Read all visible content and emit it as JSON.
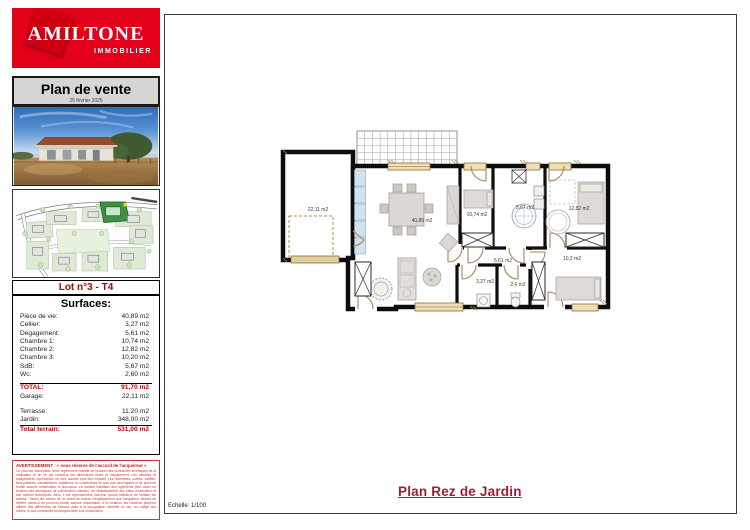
{
  "colors": {
    "brand_red": "#e2001a",
    "accent_red": "#cc0000",
    "plan_title_red": "#9e1f35"
  },
  "sidebar": {
    "logo": {
      "brand": "AMILTONE",
      "tagline": "IMMOBILIER"
    },
    "header": {
      "title": "Plan de vente",
      "date": "25 février 2025"
    },
    "lot_label": "Lot n°3 - T4",
    "surfaces": {
      "title": "Surfaces:",
      "rows": [
        {
          "label": "Pièce de vie:",
          "value": "40,89 m2"
        },
        {
          "label": "Cellier:",
          "value": "3,27 m2"
        },
        {
          "label": "Degagement:",
          "value": "5,61 m2"
        },
        {
          "label": "Chambre 1:",
          "value": "10,74 m2"
        },
        {
          "label": "Chambre 2:",
          "value": "12,82 m2"
        },
        {
          "label": "Chambre 3:",
          "value": "10,20 m2"
        },
        {
          "label": "SdB:",
          "value": "5,67 m2"
        },
        {
          "label": "Wc:",
          "value": "2,60 m2"
        }
      ],
      "summary": [
        {
          "label": "TOTAL:",
          "value": "91,70 m2"
        },
        {
          "label": "Garage:",
          "value": "22,11 m2"
        },
        {
          "label": "Terrasse:",
          "value": "11,20 m2"
        },
        {
          "label": "Jardin:",
          "value": "348,00 m2"
        },
        {
          "label": "Total terrain:",
          "value": "531,00 m2"
        }
      ]
    },
    "warning": {
      "title": "AVERTISSEMENT : « sous réserve de l'accord de l'acquéreur »",
      "body": "Ce plan est susceptible d'être légèrement modifié en fonction des contraintes techniques de la réalisation et en ce qui concerne les dimensions libres et l'équipement. Les meubles et équipements représentés ne sont donnés qu'à titre indicatif. Les retombées, coffres, soffites, faux-plafonds, canalisations, radiateurs ou convecteurs ne sont pas tous figurés et ne pourront fonder aucune réclamation ni plus-value. La surface habitable des logements peut varier en fonction des techniques de construction choisies, de l'établissement des plans d'exécution et des normes techniques. Ainsi, il est expressément convenu qu'une tolérance de surface est admise. Toutes les ventes de m² étant au niveau d'emplacement que l'acquéreur tiendra de vérifier, celles-ci ne pourront fonder aucune réclamation. A la livraison, les hauteurs pourront différer des différences de niveaux dues à la topographie naturelle du lieu, au calage des voiries, et aux contraintes techniques liées à la construction."
    }
  },
  "main": {
    "plan_title": "Plan Rez de Jardin",
    "scale": "Echelle: 1/100",
    "rooms": {
      "garage": "22,11 m2",
      "living": "40,89 m2",
      "bedroom1": "10,74 m2",
      "bathroom": "5,67 m2",
      "bedroom2": "12,82 m2",
      "hallway": "5,61 m2",
      "cellar": "3,27 m2",
      "wc": "2,6 m2",
      "bedroom3": "10,2 m2"
    }
  }
}
